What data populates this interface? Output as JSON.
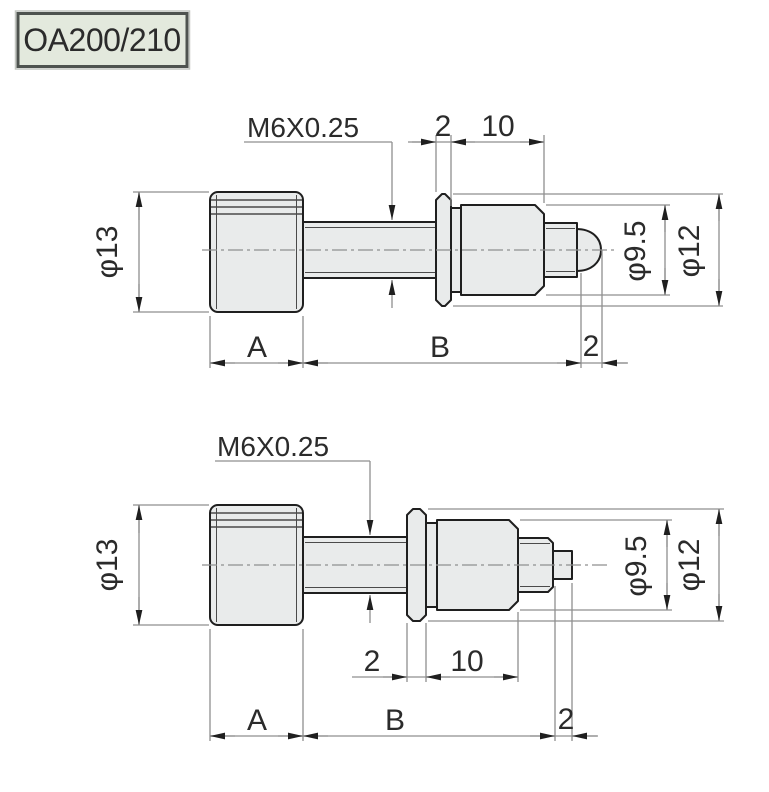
{
  "title_badge": {
    "label": "OA200/210"
  },
  "colors": {
    "page_bg": "#ffffff",
    "part_fill": "#e9ebeb",
    "outline": "#1f1f1f",
    "thin_line": "#4a4a4a",
    "dim_line": "#8f8f8f",
    "text": "#2b2b2b",
    "badge_bg": "#e3e9dd",
    "badge_border": "#4e534f"
  },
  "views": {
    "top": {
      "description": "ball-tip version",
      "thread_label": "M6X0.25",
      "knob_diameter": "φ13",
      "flange_width": "2",
      "body_length": "10",
      "body_diameter": "φ9.5",
      "flange_diameter": "φ12",
      "knob_length_label": "A",
      "body_span_label": "B",
      "tip_length": "2"
    },
    "bottom": {
      "description": "flat-tip version",
      "thread_label": "M6X0.25",
      "knob_diameter": "φ13",
      "flange_width": "2",
      "body_length": "10",
      "body_diameter": "φ9.5",
      "flange_diameter": "φ12",
      "knob_length_label": "A",
      "body_span_label": "B",
      "tip_length": "2"
    }
  }
}
